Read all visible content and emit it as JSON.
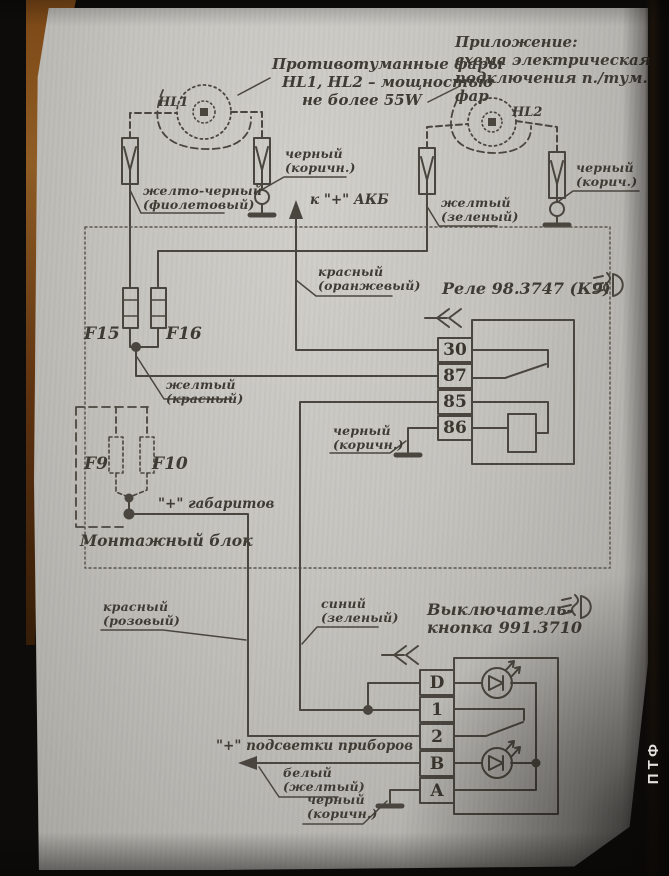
{
  "photo": {
    "side_label": "ПТФ"
  },
  "header": {
    "appendix_line1": "Приложение:",
    "appendix_line2": "схема электрическая",
    "appendix_line3": "подключения п./тум. фар"
  },
  "lamp_note": {
    "line1": "Противотуманные фары",
    "line2": "HL1, HL2 – мощностью",
    "line3": "не более 55W"
  },
  "lamps": {
    "hl1": "HL1",
    "hl2": "HL2"
  },
  "fuses": {
    "f15": "F15",
    "f16": "F16",
    "f9": "F9",
    "f10": "F10"
  },
  "relay": {
    "title": "Реле 98.3747 (К9)",
    "terminals": [
      "30",
      "87",
      "85",
      "86"
    ]
  },
  "switch": {
    "title_line1": "Выключатель-",
    "title_line2": "кнопка 991.3710",
    "terminals": [
      "D",
      "1",
      "2",
      "B",
      "A"
    ]
  },
  "labels": {
    "to_battery": "к \"+\" АКБ",
    "parking_plus": "\"+\" габаритов",
    "instrument_light_plus": "\"+\" подсветки приборов",
    "mounting_block": "Монтажный блок",
    "wire_yellow_black": {
      "l1": "желто-черный",
      "l2": "(фиолетовый)"
    },
    "wire_black_left": {
      "l1": "черный",
      "l2": "(коричн.)"
    },
    "wire_yellow_green": {
      "l1": "желтый",
      "l2": "(зеленый)"
    },
    "wire_black_right": {
      "l1": "черный",
      "l2": "(корич.)"
    },
    "wire_red_orange": {
      "l1": "красный",
      "l2": "(оранжевый)"
    },
    "wire_yellow_red": {
      "l1": "желтый",
      "l2": "(красный)"
    },
    "wire_black_relay": {
      "l1": "черный",
      "l2": "(коричн.)"
    },
    "wire_red_pink": {
      "l1": "красный",
      "l2": "(розовый)"
    },
    "wire_blue_green": {
      "l1": "синий",
      "l2": "(зеленый)"
    },
    "wire_white_yellow": {
      "l1": "белый",
      "l2": "(желтый)"
    },
    "wire_black_switch": {
      "l1": "черный",
      "l2": "(коричн.)"
    }
  },
  "colors": {
    "ink": "#4a463f",
    "paper": "#c5c3be"
  }
}
